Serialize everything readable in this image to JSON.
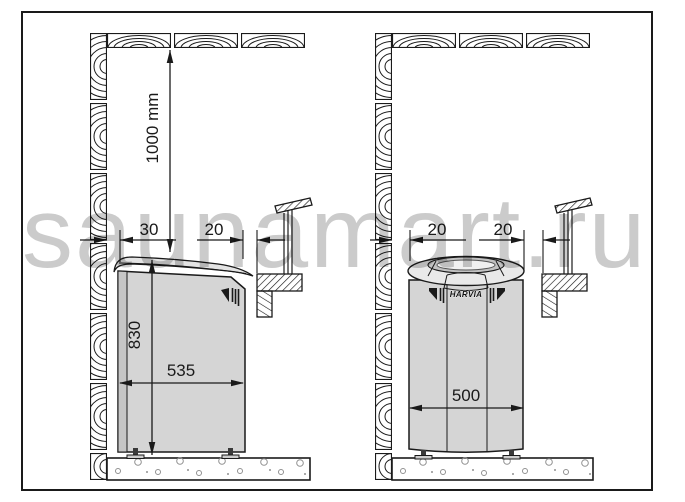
{
  "watermark": "saunamart.ru",
  "brand_label": "HARVIA",
  "dimensions": {
    "left_diagram": {
      "ceiling_clearance": "1000 mm",
      "wall_gap": "30",
      "front_gap": "20",
      "heater_height": "830",
      "heater_width": "535"
    },
    "right_diagram": {
      "wall_gap": "20",
      "front_gap": "20",
      "heater_width": "500"
    }
  },
  "colors": {
    "line": "#1a1a1a",
    "heater_fill": "#d5d5d5",
    "watermark_gray": "#c2c2c2"
  }
}
